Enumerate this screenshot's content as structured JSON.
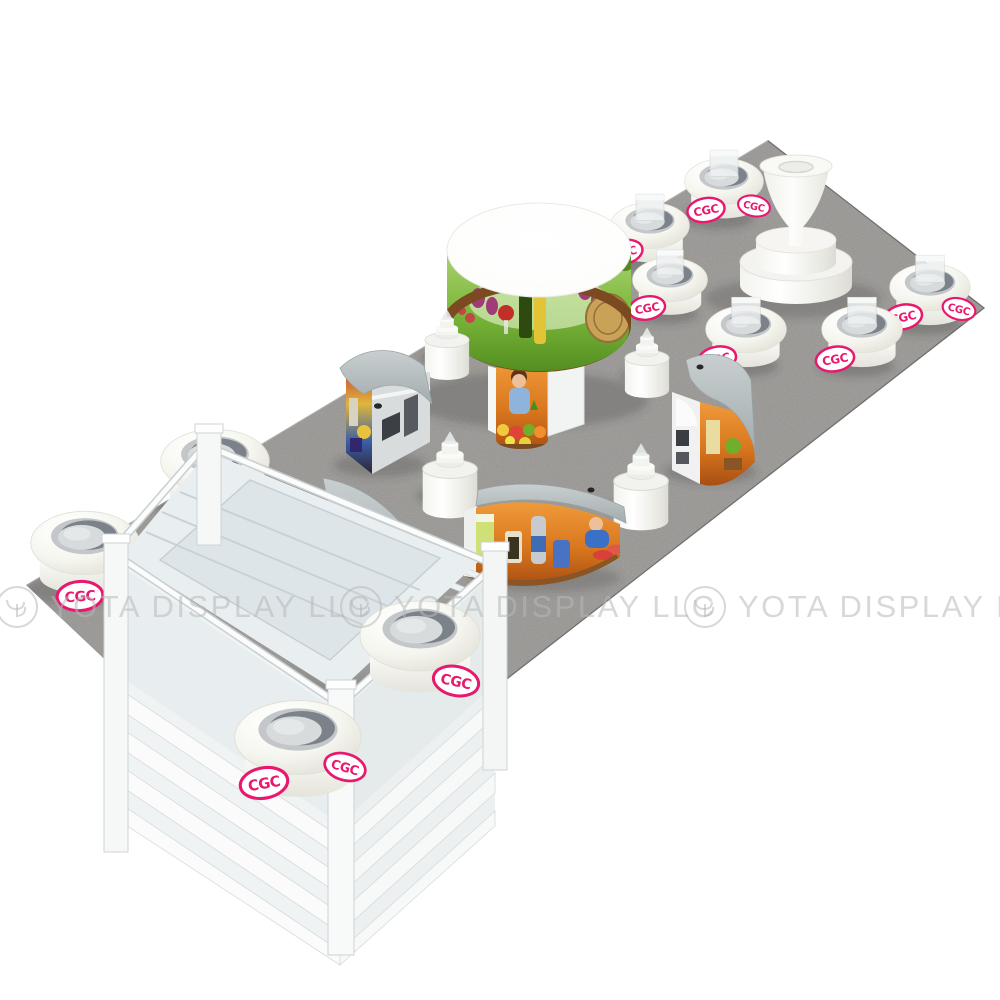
{
  "watermark": {
    "text": "YOTA DISPLAY LLC",
    "repeat_count": 3,
    "logo": "yd-monogram-circle-icon",
    "color": "rgba(184,184,184,0.55)"
  },
  "brand_badge": {
    "text": "CGC",
    "accent_color": "#e8186e",
    "background": "#ffffff",
    "shape": "ellipse-outline-badge"
  },
  "palette": {
    "background": "#ffffff",
    "carpet_gray": "#918f8c",
    "furniture_white": "#f6f6f2",
    "counter_top_gray": "#b7bec0",
    "graphic_green": "#6fae35",
    "graphic_autumn_orange": "#d9771e"
  },
  "scene": {
    "description": "3D render of trade show booth furniture set arranged on a gray rectangular carpet, isometric view",
    "objects": [
      {
        "name": "round-logo-ottoman",
        "count": 10
      },
      {
        "name": "frosted-top-stool-riser",
        "count": 6
      },
      {
        "name": "small-product-pedestal",
        "count": 4
      },
      {
        "name": "graphic-wrap-tower-table",
        "count": 1
      },
      {
        "name": "curved-graphic-counter",
        "count": 3
      },
      {
        "name": "curved-shelf-unit",
        "count": 1
      },
      {
        "name": "glass-showcase-frame",
        "count": 1
      },
      {
        "name": "flared-pedestal-stand",
        "count": 1
      }
    ]
  }
}
